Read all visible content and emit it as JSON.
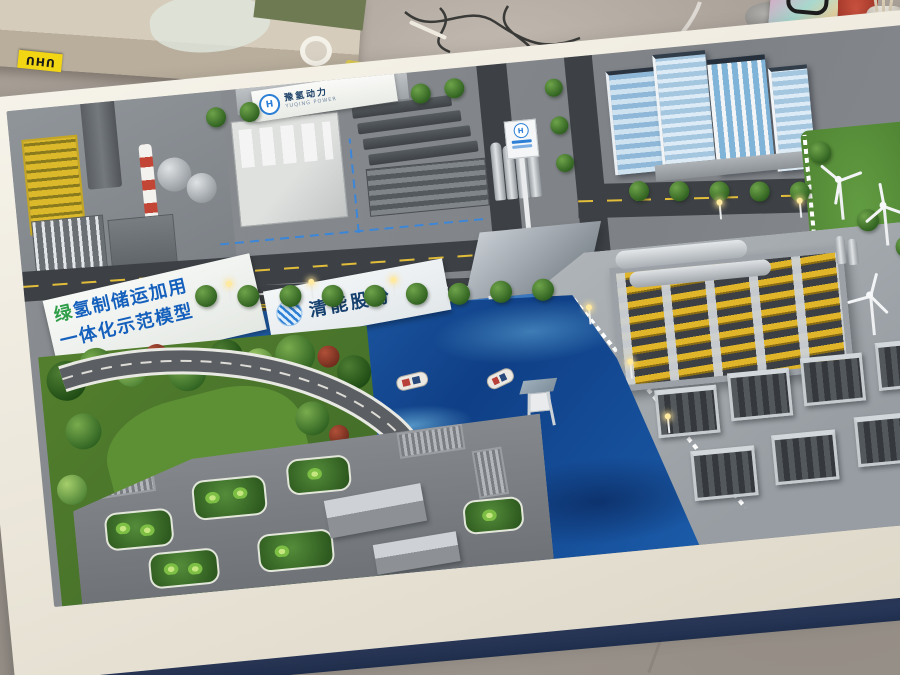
{
  "scene": {
    "type": "photograph",
    "subject": "architectural scale model of a green-hydrogen industrial park on a display table in a model-making workshop"
  },
  "model": {
    "banner": {
      "line1_first": "绿",
      "line1_rest": "氢制储运加用",
      "line2": "一体化示范模型"
    },
    "company_sign": {
      "name": "清能股份"
    },
    "factory_sign": {
      "name": "豫氢动力",
      "sub": "YUQING POWER",
      "logo_letter": "H"
    },
    "station_sign": {
      "logo_letter": "H"
    }
  },
  "workshop": {
    "glue_brand": "UHU"
  },
  "colors": {
    "water_blue": "#1c5dab",
    "water_highlight": "#8fd8f0",
    "banner_blue": "#1560bd",
    "banner_green": "#2f9e49",
    "sign_navy": "#16406e",
    "logo_blue": "#2b7fd6",
    "grass_green": "#4f8336",
    "lawn_green": "#5d8f35",
    "frame_white": "#f0ede4",
    "base_navy": "#2a3a60",
    "chimney_red": "#c24536",
    "crane_yellow": "#dcb92b",
    "pipe_yellow": "#e0b52a",
    "road_gray": "#3d4145",
    "floor_gray": "#a0988f"
  }
}
